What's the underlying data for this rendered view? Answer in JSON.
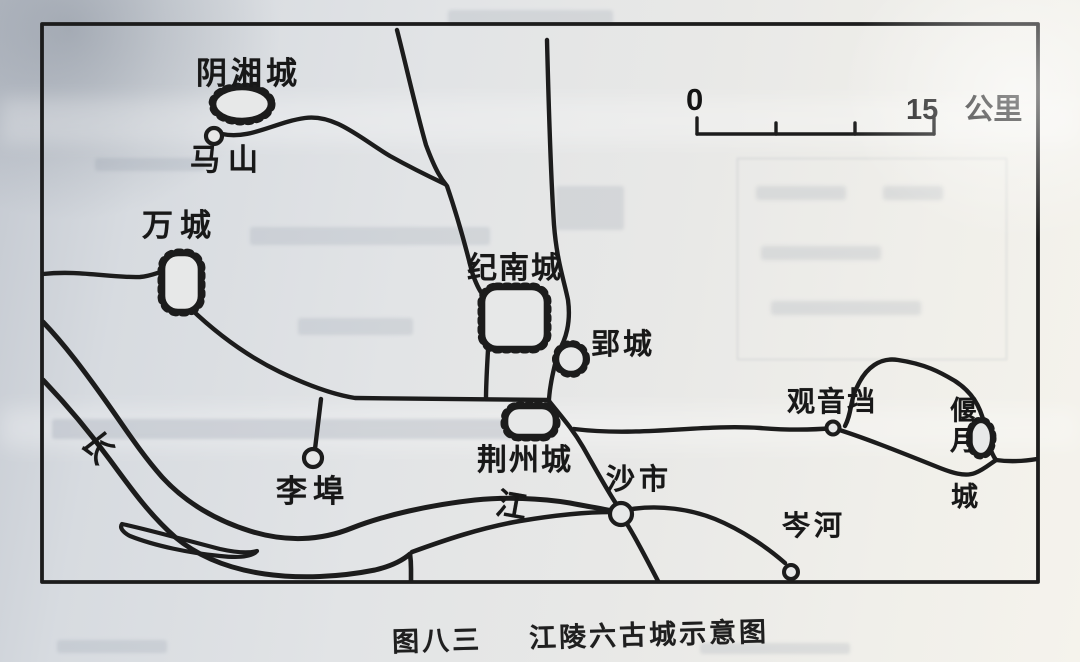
{
  "figure": {
    "number_label": "图八三",
    "title": "江陵六古城示意图"
  },
  "scale_bar": {
    "zero_label": "0",
    "distance_label": "15",
    "unit_label": "公里"
  },
  "river": {
    "name": "长江",
    "char_chang": "长",
    "char_jiang": "江"
  },
  "walled_cities": [
    {
      "name": "阴湘城"
    },
    {
      "name": "万城"
    },
    {
      "name": "纪南城"
    },
    {
      "name": "郢城"
    },
    {
      "name": "荆州城"
    },
    {
      "name": "偃月城",
      "line1": "偃月",
      "line2": "城"
    }
  ],
  "settlements": [
    {
      "name": "马山"
    },
    {
      "name": "李埠"
    },
    {
      "name": "沙市"
    },
    {
      "name": "观音垱"
    },
    {
      "name": "岑河"
    }
  ],
  "colors": {
    "ink": "#1c1c1c",
    "paper": "#e7e8e8"
  }
}
